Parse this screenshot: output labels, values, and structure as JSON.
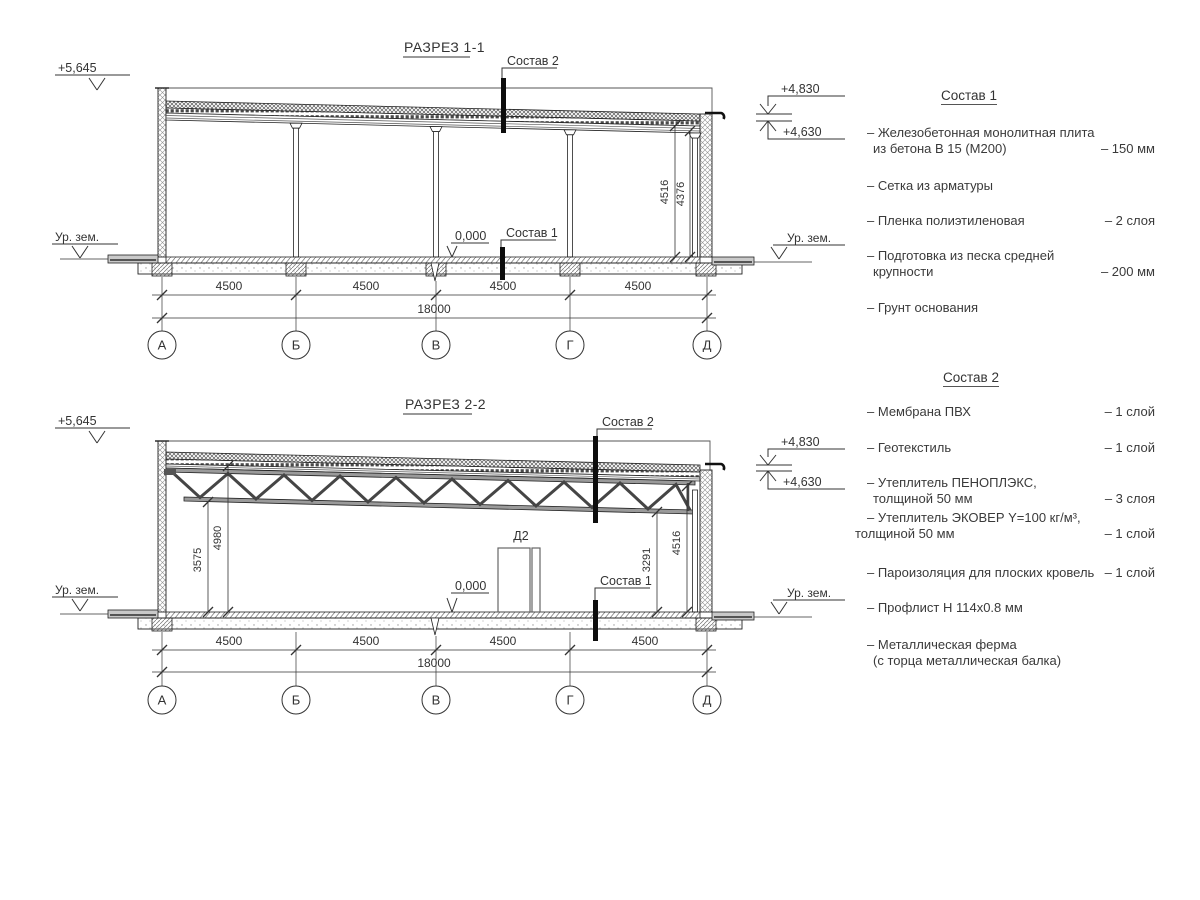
{
  "section1": {
    "title": "РАЗРЕЗ 1-1",
    "elev_parapet": "+5,645",
    "elev_roof_top": "+4,830",
    "elev_roof_bottom": "+4,630",
    "ground_label_left": "Ур. зем.",
    "ground_label_right": "Ур. зем.",
    "zero_level": "0,000",
    "callout_roof": "Состав 2",
    "callout_floor": "Состав 1",
    "dim_height_1": "4516",
    "dim_height_2": "4376",
    "dim_bays": [
      "4500",
      "4500",
      "4500",
      "4500"
    ],
    "dim_total": "18000",
    "axes": [
      "А",
      "Б",
      "В",
      "Г",
      "Д"
    ]
  },
  "section2": {
    "title": "РАЗРЕЗ 2-2",
    "elev_parapet": "+5,645",
    "elev_roof_top": "+4,830",
    "elev_roof_bottom": "+4,630",
    "ground_label_left": "Ур. зем.",
    "ground_label_right": "Ур. зем.",
    "zero_level": "0,000",
    "callout_roof": "Состав 2",
    "callout_floor": "Состав 1",
    "door_label": "Д2",
    "dim_truss_bottom": "3575",
    "dim_truss_top": "4980",
    "dim_right_clear": "3291",
    "dim_right_full": "4516",
    "dim_bays": [
      "4500",
      "4500",
      "4500",
      "4500"
    ],
    "dim_total": "18000",
    "axes": [
      "А",
      "Б",
      "В",
      "Г",
      "Д"
    ]
  },
  "sostav1": {
    "title": "Состав 1",
    "items": [
      {
        "line1": "– Железобетонная  монолитная плита",
        "line2": "из бетона В 15 (М200)",
        "value": "– 150 мм"
      },
      {
        "line1": "– Сетка из арматуры",
        "line2": "",
        "value": ""
      },
      {
        "line1": "– Пленка полиэтиленовая",
        "line2": "",
        "value": "–  2 слоя"
      },
      {
        "line1": "– Подготовка из песка средней",
        "line2": "крупности",
        "value": "– 200 мм"
      },
      {
        "line1": "– Грунт основания",
        "line2": "",
        "value": ""
      }
    ]
  },
  "sostav2": {
    "title": "Состав 2",
    "items": [
      {
        "line1": "– Мембрана ПВХ",
        "line2": "",
        "value": "– 1 слой"
      },
      {
        "line1": "– Геотекстиль",
        "line2": "",
        "value": "– 1 слой"
      },
      {
        "line1": "– Утеплитель ПЕНОПЛЭКС,",
        "line2": "толщиной 50 мм",
        "value": "– 3 слоя"
      },
      {
        "line1": "– Утеплитель ЭКОВЕР Y=100 кг/м³,",
        "line2": "толщиной 50 мм",
        "value": "– 1 слой"
      },
      {
        "line1": "– Пароизоляция для плоских кровель",
        "line2": "",
        "value": "– 1 слой"
      },
      {
        "line1": "– Профлист Н 114х0.8 мм",
        "line2": "",
        "value": ""
      },
      {
        "line1": "– Металлическая ферма",
        "line2": "(с торца металлическая балка)",
        "value": ""
      }
    ]
  }
}
